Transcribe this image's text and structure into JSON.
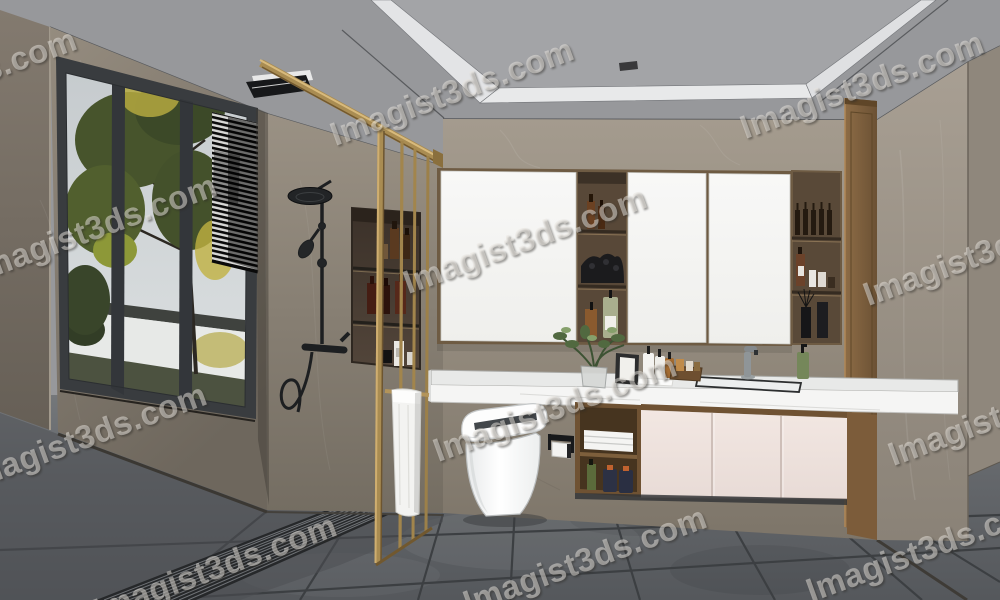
{
  "image": {
    "title": "Modern bathroom interior 3D rendering",
    "width_px": 1000,
    "height_px": 600
  },
  "watermark": {
    "text": "Imagist3ds.com",
    "angle_deg": -20,
    "font_size_px": 33,
    "color": "rgba(236,232,226,0.5)",
    "positions": [
      [
        -45,
        82
      ],
      [
        452,
        92
      ],
      [
        862,
        85
      ],
      [
        95,
        228
      ],
      [
        525,
        240
      ],
      [
        985,
        252
      ],
      [
        85,
        437
      ],
      [
        555,
        408
      ],
      [
        1010,
        412
      ],
      [
        215,
        568
      ],
      [
        585,
        560
      ],
      [
        928,
        548
      ]
    ]
  },
  "palette": {
    "gold_frame": "#a98c52",
    "wall_taupe": "#948b7e",
    "ceiling_gray": "#97989b",
    "cove_white": "#e3e4e6",
    "floor_gray": "#5d6064",
    "cabinet_pink": "#efe3de",
    "wood_brown": "#7c5c3a",
    "mirror_white": "#f5f6f4",
    "fixture_black": "#1d1f21",
    "towel_white": "#f3f3f1",
    "sky": "#c9ced1",
    "tree_green": "#47542c",
    "tree_yellow": "#b4a83f"
  },
  "objects": [
    "window with garden view",
    "venetian blind",
    "black rain shower set",
    "shower wall niche with bottles",
    "gold framed glass shower partition",
    "hanging white towel",
    "mirror cabinets",
    "open shelf niches with toiletries",
    "tall wood cabinet",
    "white marble vanity counter",
    "basin and faucet",
    "smart toilet",
    "toilet paper holder",
    "pink under-counter cabinets",
    "folded towels",
    "potted plant",
    "linear floor drain grate",
    "recessed tray ceiling with vents",
    "gray tiled floor"
  ]
}
